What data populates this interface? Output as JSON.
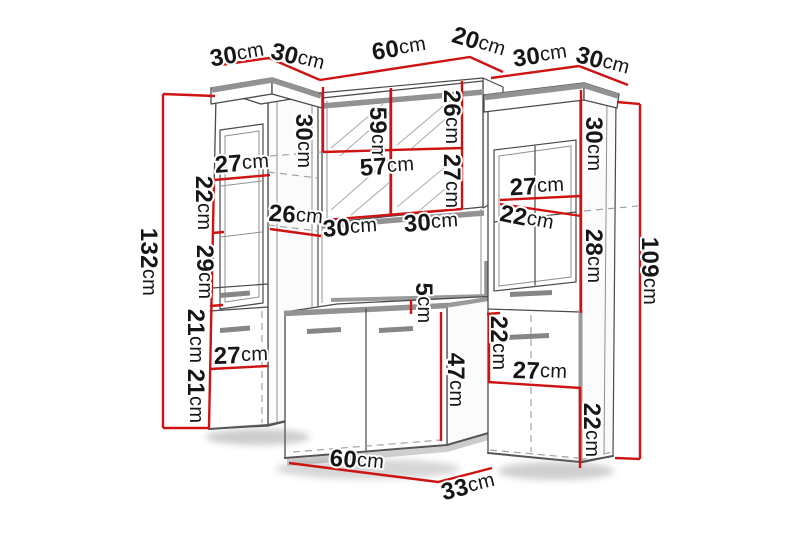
{
  "diagram": {
    "type": "furniture-dimension-diagram",
    "unit_default": "cm",
    "colors": {
      "background": "#ffffff",
      "dimension_line": "#ce1313",
      "outline": "#4a4a4a",
      "accent_gray": "#929292",
      "label_text": "#161616"
    },
    "labels": [
      {
        "value": "30",
        "unit": "cm",
        "x": 237,
        "y": 54,
        "rot": -10,
        "group": "left-cabinet"
      },
      {
        "value": "30",
        "unit": "cm",
        "x": 298,
        "y": 57,
        "rot": 14,
        "group": "left-cabinet"
      },
      {
        "value": "60",
        "unit": "cm",
        "x": 399,
        "y": 48,
        "rot": -9,
        "group": "mirror-cabinet"
      },
      {
        "value": "20",
        "unit": "cm",
        "x": 479,
        "y": 42,
        "rot": 17,
        "group": "mirror-cabinet"
      },
      {
        "value": "30",
        "unit": "cm",
        "x": 540,
        "y": 55,
        "rot": -8,
        "group": "right-cabinet"
      },
      {
        "value": "30",
        "unit": "cm",
        "x": 603,
        "y": 61,
        "rot": 15,
        "group": "right-cabinet"
      },
      {
        "value": "132",
        "unit": "cm",
        "x": 149,
        "y": 262,
        "rot": 90,
        "group": "left-cabinet"
      },
      {
        "value": "27",
        "unit": "cm",
        "x": 242,
        "y": 163,
        "rot": -4,
        "group": "left-cabinet"
      },
      {
        "value": "22",
        "unit": "cm",
        "x": 204,
        "y": 203,
        "rot": 90,
        "group": "left-cabinet"
      },
      {
        "value": "26",
        "unit": "cm",
        "x": 296,
        "y": 215,
        "rot": 5,
        "group": "left-cabinet"
      },
      {
        "value": "29",
        "unit": "cm",
        "x": 205,
        "y": 272,
        "rot": 90,
        "group": "left-cabinet"
      },
      {
        "value": "21",
        "unit": "cm",
        "x": 196,
        "y": 336,
        "rot": 90,
        "group": "left-cabinet"
      },
      {
        "value": "27",
        "unit": "cm",
        "x": 241,
        "y": 355,
        "rot": -2,
        "group": "left-cabinet"
      },
      {
        "value": "21",
        "unit": "cm",
        "x": 196,
        "y": 396,
        "rot": 90,
        "group": "left-cabinet"
      },
      {
        "value": "30",
        "unit": "cm",
        "x": 304,
        "y": 141,
        "rot": 90,
        "group": "mirror-cabinet"
      },
      {
        "value": "59",
        "unit": "cm",
        "x": 378,
        "y": 134,
        "rot": 90,
        "group": "mirror-cabinet"
      },
      {
        "value": "26",
        "unit": "cm",
        "x": 452,
        "y": 117,
        "rot": 90,
        "group": "mirror-cabinet"
      },
      {
        "value": "57",
        "unit": "cm",
        "x": 387,
        "y": 166,
        "rot": -4,
        "group": "mirror-cabinet"
      },
      {
        "value": "27",
        "unit": "cm",
        "x": 452,
        "y": 181,
        "rot": 90,
        "group": "mirror-cabinet"
      },
      {
        "value": "30",
        "unit": "cm",
        "x": 350,
        "y": 227,
        "rot": -4,
        "group": "mirror-cabinet"
      },
      {
        "value": "30",
        "unit": "cm",
        "x": 431,
        "y": 222,
        "rot": -4,
        "group": "mirror-cabinet"
      },
      {
        "value": "5",
        "unit": "cm",
        "x": 424,
        "y": 303,
        "rot": 90,
        "group": "vanity-cabinet"
      },
      {
        "value": "47",
        "unit": "cm",
        "x": 456,
        "y": 380,
        "rot": 90,
        "group": "vanity-cabinet"
      },
      {
        "value": "60",
        "unit": "cm",
        "x": 357,
        "y": 460,
        "rot": 5,
        "group": "vanity-cabinet"
      },
      {
        "value": "33",
        "unit": "cm",
        "x": 468,
        "y": 486,
        "rot": -14,
        "group": "vanity-cabinet"
      },
      {
        "value": "30",
        "unit": "cm",
        "x": 594,
        "y": 144,
        "rot": 90,
        "group": "right-cabinet"
      },
      {
        "value": "27",
        "unit": "cm",
        "x": 537,
        "y": 186,
        "rot": -3,
        "group": "right-cabinet"
      },
      {
        "value": "22",
        "unit": "cm",
        "x": 527,
        "y": 218,
        "rot": 11,
        "group": "right-cabinet"
      },
      {
        "value": "28",
        "unit": "cm",
        "x": 594,
        "y": 256,
        "rot": 90,
        "group": "right-cabinet"
      },
      {
        "value": "22",
        "unit": "cm",
        "x": 499,
        "y": 343,
        "rot": 90,
        "group": "right-cabinet"
      },
      {
        "value": "27",
        "unit": "cm",
        "x": 540,
        "y": 371,
        "rot": 2,
        "group": "right-cabinet"
      },
      {
        "value": "22",
        "unit": "cm",
        "x": 592,
        "y": 430,
        "rot": 90,
        "group": "right-cabinet"
      },
      {
        "value": "109",
        "unit": "cm",
        "x": 650,
        "y": 271,
        "rot": 90,
        "group": "right-cabinet"
      }
    ]
  }
}
